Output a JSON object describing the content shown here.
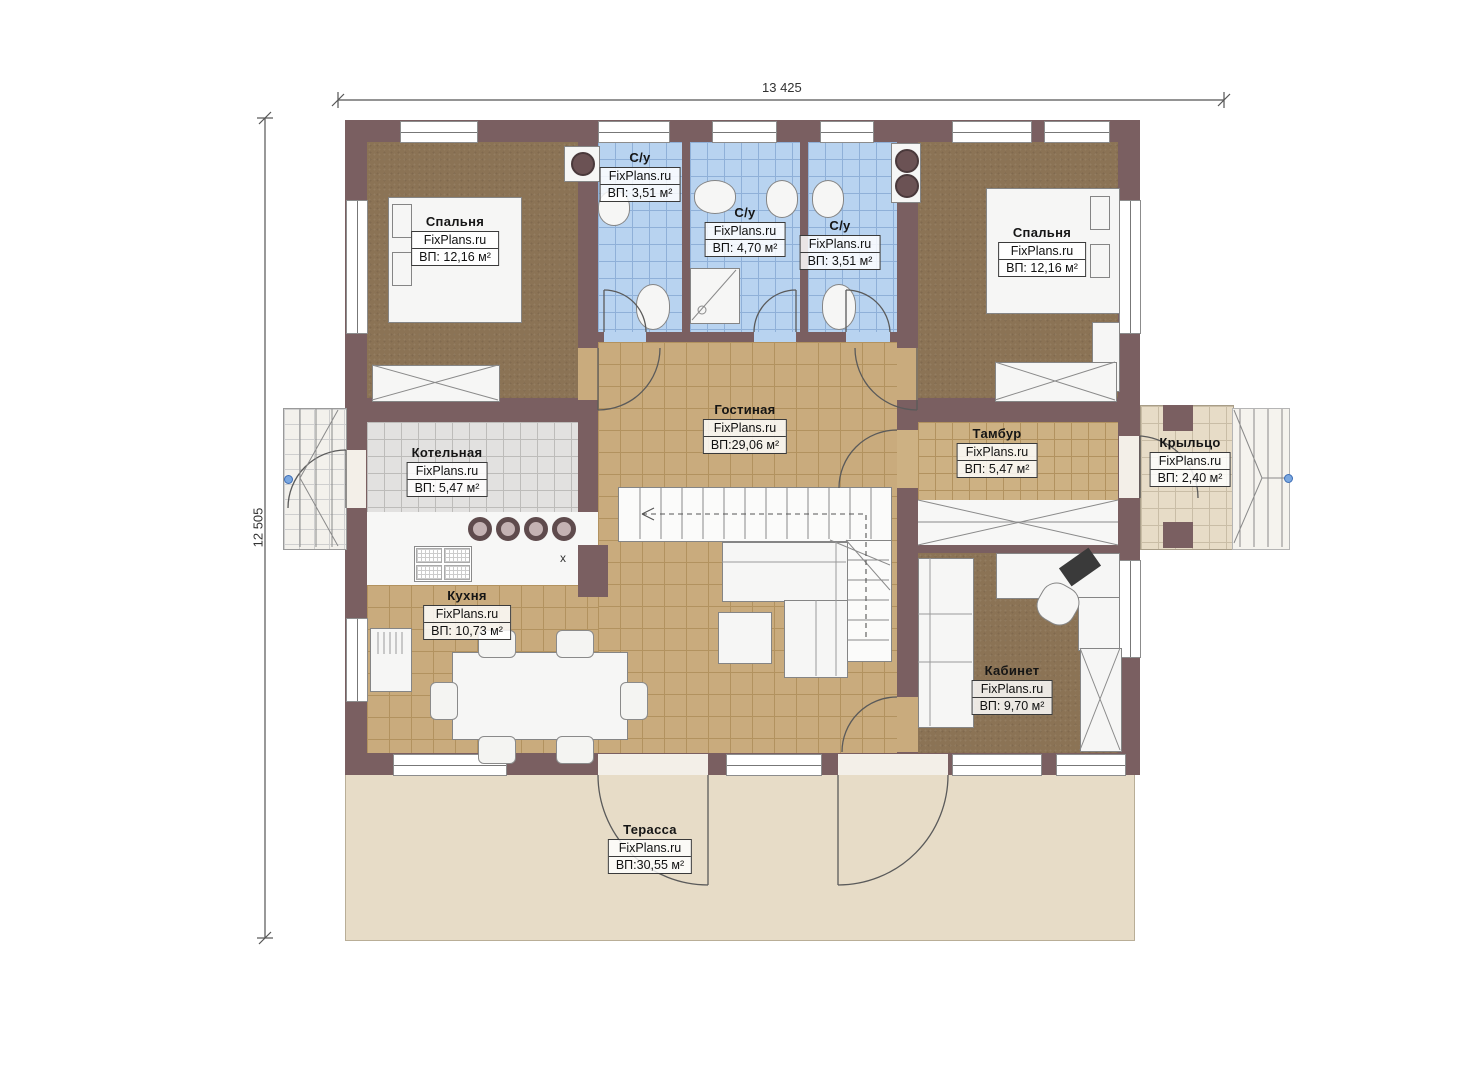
{
  "plan": {
    "watermark": "FixPlans.ru",
    "dimensions": {
      "top": "13 425",
      "left": "12 505"
    },
    "kitchen_sink_marker": "x",
    "rooms": [
      {
        "key": "bedroom-left",
        "name": "Спальня",
        "area": "ВП: 12,16 м²"
      },
      {
        "key": "bathroom-left",
        "name": "С/у",
        "area": "ВП: 3,51 м²"
      },
      {
        "key": "bathroom-center",
        "name": "С/у",
        "area": "ВП: 4,70 м²"
      },
      {
        "key": "bathroom-right",
        "name": "С/у",
        "area": "ВП: 3,51 м²"
      },
      {
        "key": "bedroom-right",
        "name": "Спальня",
        "area": "ВП: 12,16 м²"
      },
      {
        "key": "living-room",
        "name": "Гостиная",
        "area": "ВП:29,06 м²"
      },
      {
        "key": "boiler-room",
        "name": "Котельная",
        "area": "ВП: 5,47 м²"
      },
      {
        "key": "vestibule",
        "name": "Тамбур",
        "area": "ВП: 5,47 м²"
      },
      {
        "key": "porch",
        "name": "Крыльцо",
        "area": "ВП: 2,40 м²"
      },
      {
        "key": "kitchen",
        "name": "Кухня",
        "area": "ВП: 10,73 м²"
      },
      {
        "key": "office",
        "name": "Кабинет",
        "area": "ВП: 9,70 м²"
      },
      {
        "key": "terrace",
        "name": "Терасса",
        "area": "ВП:30,55 м²"
      }
    ],
    "colors": {
      "wall": "#7a5f61",
      "bedroom_floor": "#8b7355",
      "bath_floor": "#b8d3f0",
      "hall_floor": "#c9ab7d",
      "boiler_floor": "#e2e1e0",
      "terrace_floor": "#e7dcc7"
    }
  }
}
